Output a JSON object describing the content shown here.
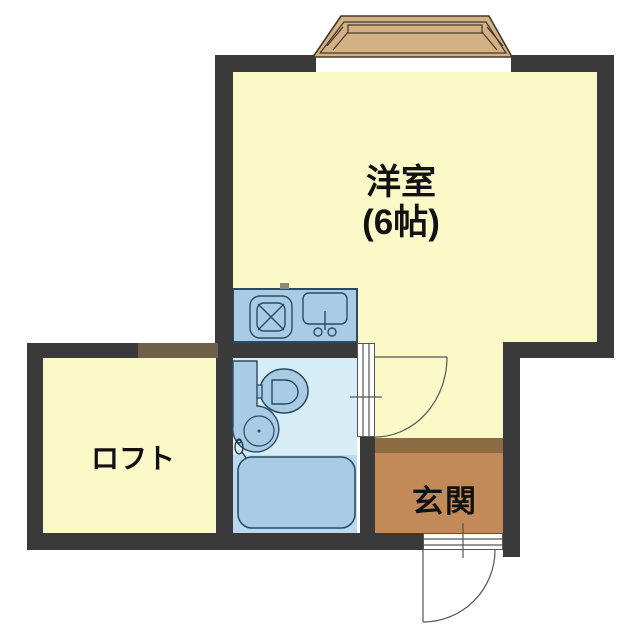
{
  "figure": {
    "type": "japanese-apartment-floor-plan"
  },
  "rooms": {
    "main_room": {
      "label": "洋室",
      "size": "(6帖)"
    },
    "loft": {
      "label": "ロフト"
    },
    "entrance": {
      "label": "玄関"
    }
  },
  "fixtures": {
    "bay_window": "bay-window",
    "stove": "gas-stove-icon",
    "kitchen_sink": "kitchen-sink-icon",
    "toilet": "toilet-icon",
    "vanity_basin": "vanity-basin-icon",
    "bath_faucet": "bath-faucet-icon",
    "bathtub": "bathtub-icon",
    "bath_door": "bath-door-swing",
    "entry_door": "entry-door-swing"
  },
  "palette": {
    "wall": "#3a3a3a",
    "room_yellow": "#fcf9c8",
    "bay_tan": "#d2b285",
    "bay_outline": "#44372a",
    "brown_wall": "#6e6048",
    "genkan_step": "#8d6c44",
    "genkan_floor": "#c28a58",
    "fixture_blue": "#a9cbe3",
    "bathroom_blue": "#d7edf5",
    "bath_area_blue": "#b9d9ec",
    "outline_navy": "#2b4a66",
    "door_line": "#555555",
    "text": "#111111"
  }
}
